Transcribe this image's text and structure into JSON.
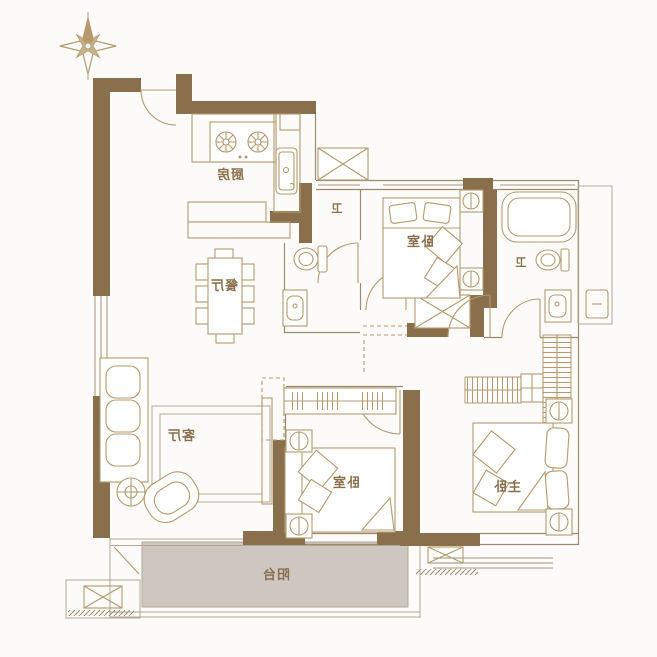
{
  "plan": {
    "type": "apartment-floor-plan",
    "text_mirrored": true,
    "rooms": {
      "kitchen": {
        "label": "厨房"
      },
      "dining": {
        "label": "餐厅"
      },
      "living": {
        "label": "客厅"
      },
      "bath_hall": {
        "label": "卫"
      },
      "bath_master": {
        "label": "卫"
      },
      "bedroom_top": {
        "label": "卧室"
      },
      "bedroom_bottom": {
        "label": "卧室"
      },
      "master_bedroom": {
        "label": "主卧"
      },
      "balcony": {
        "label": "阳台"
      }
    },
    "colors": {
      "wall": "#8a6f4c",
      "furniture_line": "#b49a6e",
      "balcony_fill": "#cec6c0",
      "label": "#8a6f4c",
      "background": "#fcfbf9"
    },
    "icons": [
      "compass-icon",
      "stove-icon",
      "sink-icon",
      "toilet-icon",
      "bathtub-icon",
      "washbasin-icon",
      "bed-icon",
      "wardrobe-icon",
      "sofa-icon",
      "armchair-icon",
      "plant-icon",
      "dining-table-icon",
      "shaft-x-icon",
      "door-arc-icon",
      "window-icon"
    ]
  }
}
